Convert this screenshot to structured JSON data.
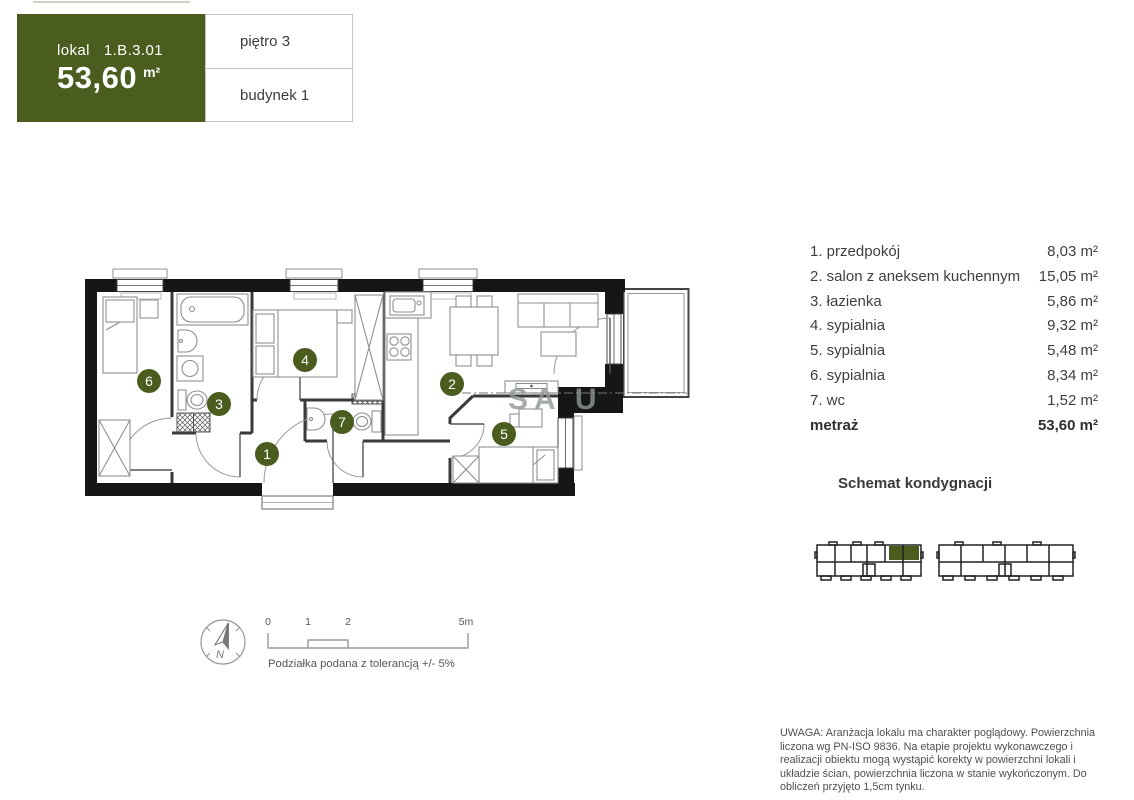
{
  "header": {
    "lokal_label": "lokal",
    "lokal_value": "1.B.3.01",
    "area_value": "53,60",
    "area_unit": "m²",
    "floor": "piętro 3",
    "building": "budynek 1"
  },
  "rooms": [
    {
      "number": "1",
      "label": "1. przedpokój",
      "area": "8,03 m²"
    },
    {
      "number": "2",
      "label": "2. salon z aneksem kuchennym",
      "area": "15,05 m²"
    },
    {
      "number": "3",
      "label": "3. łazienka",
      "area": "5,86 m²"
    },
    {
      "number": "4",
      "label": "4. sypialnia",
      "area": "9,32 m²"
    },
    {
      "number": "5",
      "label": "5. sypialnia",
      "area": "5,48 m²"
    },
    {
      "number": "6",
      "label": "6. sypialnia",
      "area": "8,34 m²"
    },
    {
      "number": "7",
      "label": "7. wc",
      "area": "1,52 m²"
    }
  ],
  "total": {
    "label": "metraż",
    "value": "53,60 m²"
  },
  "floor_schematic": {
    "title": "Schemat kondygnacji"
  },
  "scale_bar": {
    "tick0": "0",
    "tick1": "1",
    "tick2": "2",
    "tick5": "5m",
    "caption": "Podziałka podana z tolerancją +/- 5%"
  },
  "compass": {
    "north_label": "N"
  },
  "watermark": "SA U",
  "disclaimer": "UWAGA: Aranżacja lokalu ma charakter poglądowy. Powierzchnia liczona wg PN-ISO 9836. Na etapie projektu wykonawczego i realizacji obiektu mogą wystąpić korekty w powierzchni lokali i układzie ścian, powierzchnia liczona w stanie wykończonym. Do obliczeń przyjęto 1,5cm tynku.",
  "colors": {
    "accent": "#4a5c1e",
    "wall": "#161616"
  }
}
